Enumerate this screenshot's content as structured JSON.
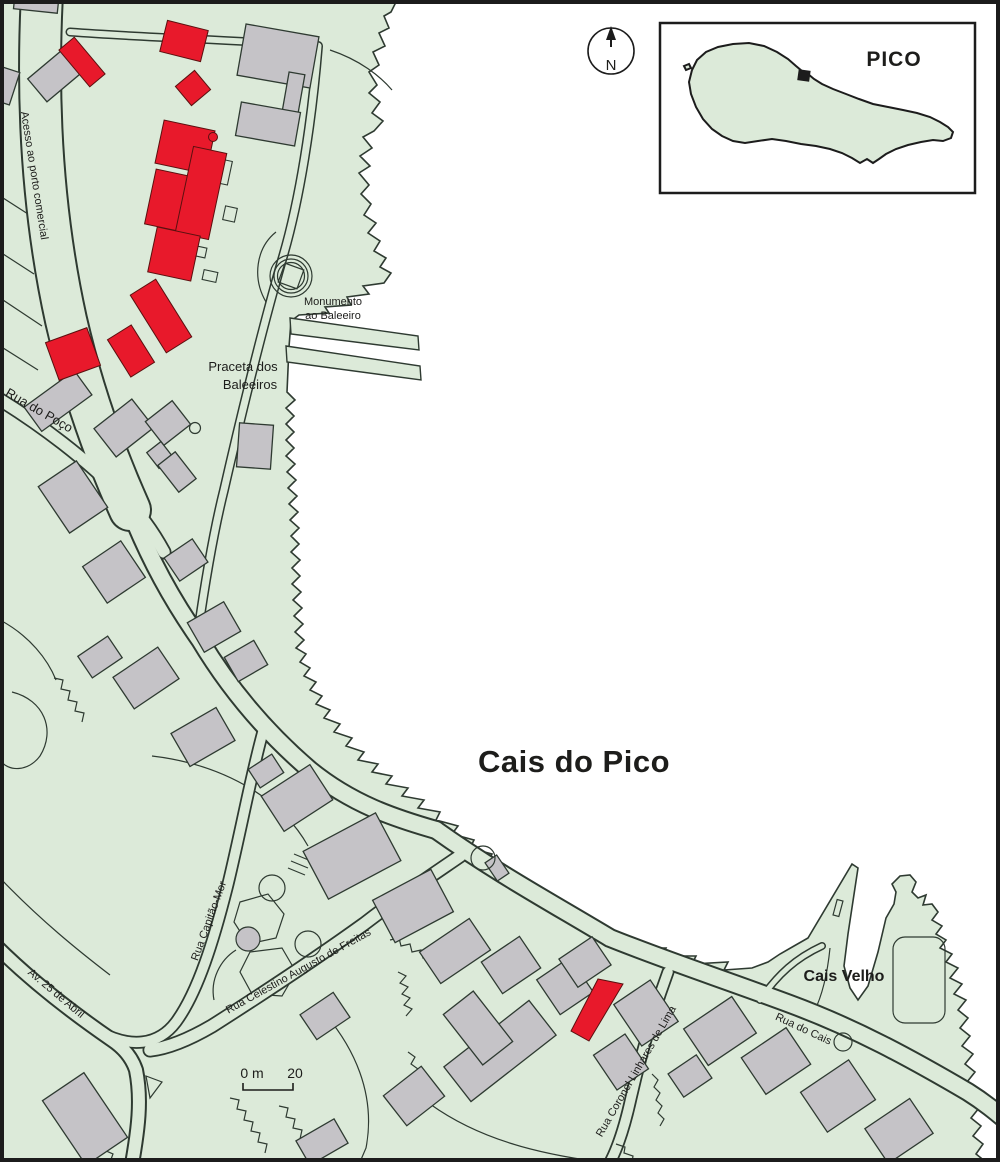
{
  "map_labels": {
    "acesso": "Acesso ao porto comercial",
    "rua_do_poco": "Rua do Poço",
    "praceta_line1": "Praceta dos",
    "praceta_line2": "Baleeiros",
    "monumento_line1": "Monumento",
    "monumento_line2": "ao Baleeiro",
    "cais_do_pico": "Cais do Pico",
    "cais_velho": "Cais Velho",
    "rua_capitao_mor": "Rua Capitão-Mor",
    "av_25_de_abril": "Av. 25 de Abril",
    "rua_celestino": "Rua Celestino Augusto de Freitas",
    "rua_coronel": "Rua Coronel Linhares de Lima",
    "rua_do_cais": "Rua do Cais"
  },
  "compass": {
    "north_label": "N"
  },
  "inset": {
    "island_label": "PICO"
  },
  "scale_bar": {
    "zero_label": "0 m",
    "twenty_label": "20"
  },
  "colors": {
    "land": "#dcead9",
    "sea": "#ffffff",
    "building": "#c5c3c7",
    "highlight_red": "#e8192b",
    "line": "#2e3a31",
    "text": "#1d1d1b"
  }
}
